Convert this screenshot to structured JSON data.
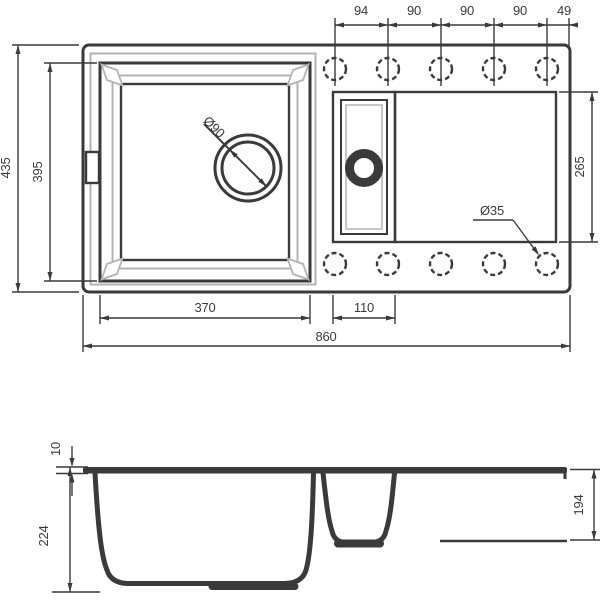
{
  "drawing": {
    "colors": {
      "line_dark": "#3a3a3a",
      "line_gray": "#b3b3b3",
      "fill_gray": "#d4d4d4"
    },
    "top_view": {
      "hole_spacing": [
        "94",
        "90",
        "90",
        "90",
        "49"
      ],
      "overall_width": "860",
      "overall_depth": "435",
      "bowl_opening_depth": "395",
      "bowl_opening_width": "370",
      "half_bowl_width": "110",
      "right_section_depth": "265",
      "drain_diameter": "Ø90",
      "tap_hole_diameter": "Ø35"
    },
    "section_view": {
      "rim_height": "10",
      "bowl_depth": "224",
      "right_depth": "194"
    }
  }
}
